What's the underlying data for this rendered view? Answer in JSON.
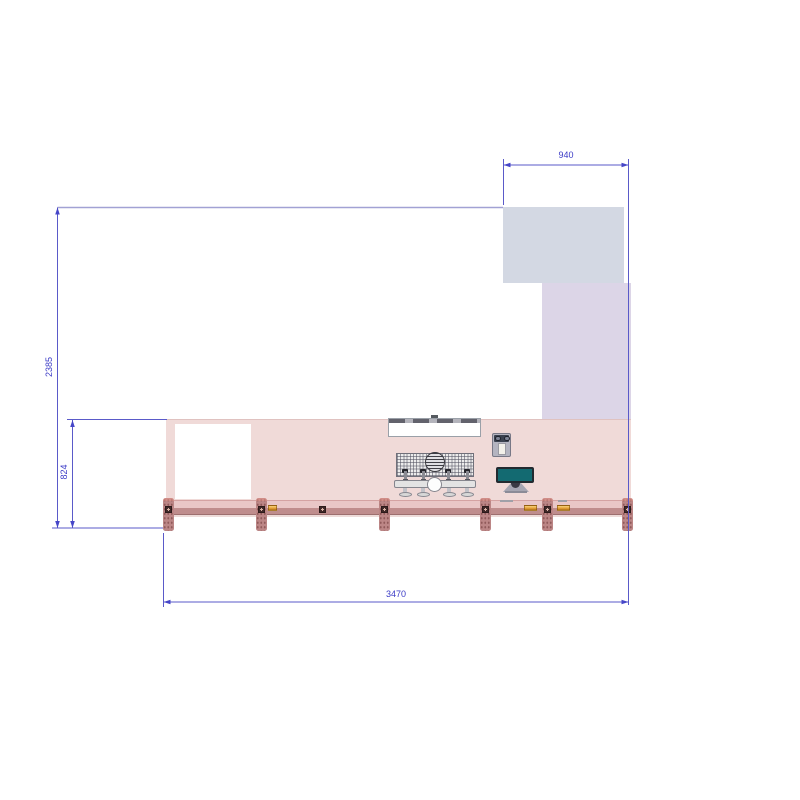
{
  "drawing": {
    "dimension_labels": {
      "top_width": "940",
      "left_height": "2385",
      "counter_height": "824",
      "bottom_width": "3470"
    },
    "colors": {
      "dimension_line": "#5a5ac9",
      "dimension_text": "#3b3bc6",
      "outline": "#a2a2d4",
      "upper_panel": "#d3d8e3",
      "side_panel": "#dcd5e7",
      "wall": "#f0dad8",
      "counter_band": "#e9c7c7",
      "counter_rail": "#bf8d8d",
      "post": "#bc8686",
      "monitor_screen": "#136a71",
      "clip_amber": "#e5a23a"
    }
  }
}
